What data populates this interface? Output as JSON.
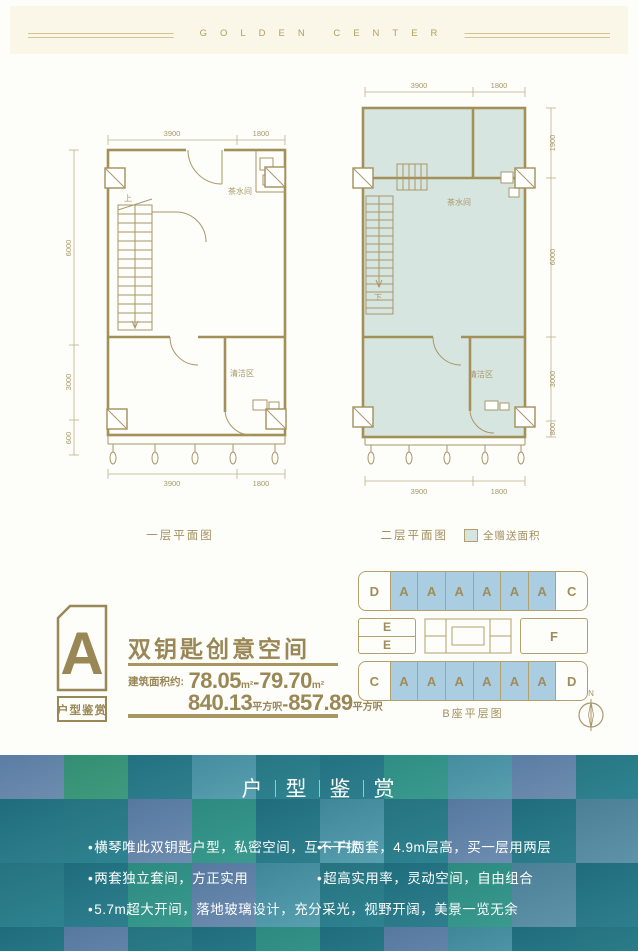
{
  "header": {
    "brand": "GOLDEN CENTER"
  },
  "floor1": {
    "caption": "一层平面图",
    "dims_top": [
      "3900",
      "1800"
    ],
    "dims_bottom": [
      "3900",
      "1800"
    ],
    "dims_left": [
      "6000",
      "3000",
      "600"
    ],
    "labels": {
      "stairs": "上",
      "tea_room": "茶水间",
      "clean_area": "清洁区"
    }
  },
  "floor2": {
    "caption": "二层平面图",
    "legend": "全赠送面积",
    "dims_top": [
      "3900",
      "1800"
    ],
    "dims_bottom": [
      "3900",
      "1800"
    ],
    "dims_right": [
      "1900",
      "6000",
      "3000",
      "800"
    ],
    "labels": {
      "stairs": "下",
      "tea_room": "茶水间",
      "clean_area": "清洁区"
    }
  },
  "unit": {
    "badge_letter": "A",
    "badge_caption": "户型鉴赏",
    "title": "双钥匙创意空间",
    "area_label": "建筑面积约:",
    "sqm_from": "78.05",
    "sqm_unit": "m²",
    "dash": "-",
    "sqm_to": "79.70",
    "sqft_from": "840.13",
    "sqft_unit": "平方呎",
    "sqft_to": "857.89"
  },
  "building": {
    "caption": "B座平层图",
    "row_top": [
      "D",
      "A",
      "A",
      "A",
      "A",
      "A",
      "A",
      "C"
    ],
    "row_mid_left": [
      "E",
      "E"
    ],
    "row_mid_right": "F",
    "row_bottom": [
      "C",
      "A",
      "A",
      "A",
      "A",
      "A",
      "A",
      "D"
    ],
    "compass": "N",
    "highlight_color": "#aacde2"
  },
  "bottom": {
    "title_chars": [
      "户",
      "型",
      "鉴",
      "赏"
    ],
    "bullet_glyph": "•",
    "bullets": [
      "横琴唯此双钥匙户型，私密空间，互不干扰",
      "一户两套，4.9m层高，买一层用两层",
      "两套独立套间，方正实用",
      "超高实用率，灵动空间，自由组合",
      "5.7m超大开间，落地玻璃设计，充分采光，视野开阔，美景一览无余"
    ]
  },
  "colors": {
    "gold": "#9a8756",
    "plan_fill": "#d7e5e1",
    "cell_blue": "#aacde2"
  }
}
